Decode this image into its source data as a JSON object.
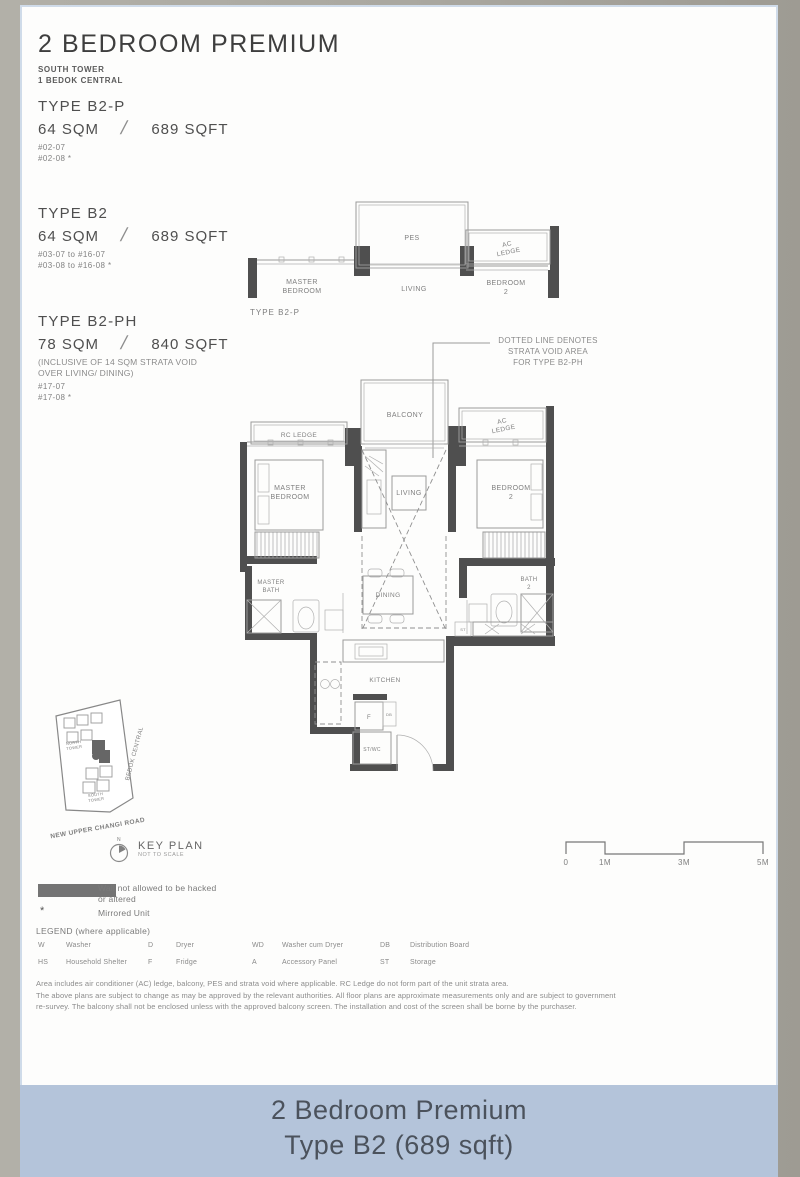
{
  "header": {
    "title": "2 BEDROOM PREMIUM",
    "subtitle_lines": [
      "SOUTH TOWER",
      "1 BEDOK CENTRAL"
    ]
  },
  "types": [
    {
      "name": "TYPE B2-P",
      "sqm": "64 SQM",
      "slash": "/",
      "sqft": "689 SQFT",
      "units": [
        "#02-07",
        "#02-08 *"
      ]
    },
    {
      "name": "TYPE B2",
      "sqm": "64 SQM",
      "slash": "/",
      "sqft": "689 SQFT",
      "units": [
        "#03-07 to #16-07",
        "#03-08 to #16-08 *"
      ]
    },
    {
      "name": "TYPE B2-PH",
      "sqm": "78 SQM",
      "slash": "/",
      "sqft": "840 SQFT",
      "note_lines": [
        "(INCLUSIVE OF 14 SQM STRATA VOID",
        "OVER LIVING/ DINING)"
      ],
      "units": [
        "#17-07",
        "#17-08 *"
      ]
    }
  ],
  "void_note": {
    "lines": [
      "DOTTED LINE DENOTES",
      "STRATA VOID AREA",
      "FOR TYPE B2-PH"
    ]
  },
  "plan_b2p": {
    "caption": "TYPE B2-P",
    "labels": {
      "pes": "PES",
      "ac_ledge": [
        "AC",
        "LEDGE"
      ],
      "master_bedroom": [
        "MASTER",
        "BEDROOM"
      ],
      "living": "LIVING",
      "bedroom2": [
        "BEDROOM",
        "2"
      ]
    }
  },
  "main_plan": {
    "labels": {
      "rc_ledge": "RC LEDGE",
      "balcony": "BALCONY",
      "ac_ledge": [
        "AC",
        "LEDGE"
      ],
      "master_bedroom": [
        "MASTER",
        "BEDROOM"
      ],
      "living": "LIVING",
      "bedroom2": [
        "BEDROOM",
        "2"
      ],
      "master_bath": [
        "MASTER",
        "BATH"
      ],
      "dining": "DINING",
      "bath2": [
        "BATH",
        "2"
      ],
      "kitchen": "KITCHEN",
      "fridge": "F",
      "db": "DB",
      "st_wc": "ST/WC",
      "st": "ST"
    }
  },
  "key_plan": {
    "north_tower": [
      "NORTH",
      "TOWER"
    ],
    "south_tower": [
      "SOUTH",
      "TOWER"
    ],
    "bedok_central": "BEDOK CENTRAL",
    "road": "NEW UPPER CHANGI ROAD",
    "compass": "N",
    "title": "KEY PLAN",
    "subtitle": "NOT TO SCALE"
  },
  "scale_bar": {
    "ticks": [
      "0",
      "1M",
      "3M",
      "5M"
    ]
  },
  "legend": {
    "wall_note_lines": [
      "Wall not allowed to be hacked",
      "or altered"
    ],
    "mirrored_symbol": "*",
    "mirrored_label": "Mirrored Unit",
    "heading": "LEGEND (where applicable)",
    "abbreviations": [
      {
        "key": "W",
        "label": "Washer"
      },
      {
        "key": "D",
        "label": "Dryer"
      },
      {
        "key": "WD",
        "label": "Washer cum Dryer"
      },
      {
        "key": "DB",
        "label": "Distribution Board"
      },
      {
        "key": "HS",
        "label": "Household Shelter"
      },
      {
        "key": "F",
        "label": "Fridge"
      },
      {
        "key": "A",
        "label": "Accessory Panel"
      },
      {
        "key": "ST",
        "label": "Storage"
      }
    ]
  },
  "disclaimer": {
    "lines": [
      "Area includes air conditioner (AC) ledge, balcony, PES and strata void where applicable.  RC Ledge do not form part of the unit strata area.",
      "The above plans are subject to change as may be approved by the relevant authorities. All floor plans are approximate measurements only and are subject to government",
      "re-survey. The balcony shall not be enclosed unless with the approved balcony screen. The installation and cost of the screen shall be borne by the purchaser."
    ]
  },
  "caption": {
    "line1": "2 Bedroom Premium",
    "line2": "Type B2 (689 sqft)"
  },
  "colors": {
    "caption_bar": "#b4c4da",
    "wall": "#4f4f4f"
  }
}
